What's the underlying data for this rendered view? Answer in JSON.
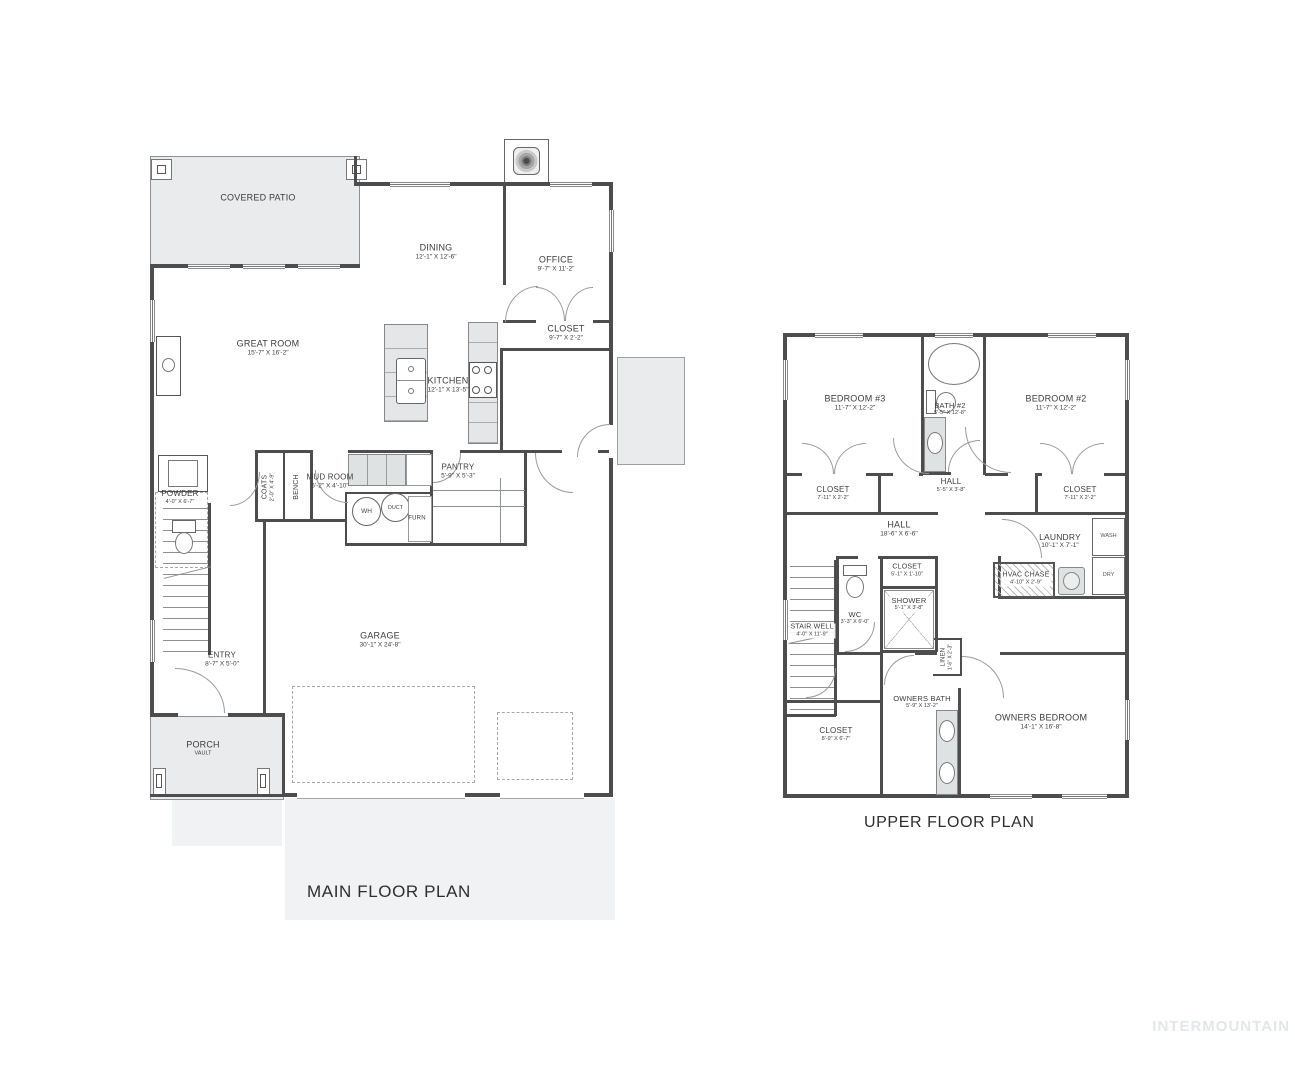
{
  "titles": {
    "main": "MAIN FLOOR PLAN",
    "upper": "UPPER FLOOR PLAN"
  },
  "watermark": "INTERMOUNTAIN",
  "colors": {
    "wall": "#4d4d4d",
    "fill": "#e9ebec",
    "line": "#9b9b9b",
    "text": "#3d3d3d"
  },
  "m": {
    "patio": {
      "name": "COVERED PATIO"
    },
    "dining": {
      "name": "DINING",
      "dims": "12'-1\" X 12'-6\""
    },
    "office": {
      "name": "OFFICE",
      "dims": "9'-7\" X 11'-2\""
    },
    "closet_office": {
      "name": "CLOSET",
      "dims": "9'-7\" X 2'-2\""
    },
    "great_room": {
      "name": "GREAT ROOM",
      "dims": "15'-7\" X 16'-2\""
    },
    "kitchen": {
      "name": "KITCHEN",
      "dims": "12'-1\" X 13'-5\""
    },
    "mud_room": {
      "name": "MUD ROOM",
      "dims": "5'-2\" X 4'-10\""
    },
    "pantry": {
      "name": "PANTRY",
      "dims": "5'-9\" X 5'-3\""
    },
    "coats": {
      "name": "COATS",
      "dims": "2'-0\" X 4'-9\""
    },
    "bench": {
      "name": "BENCH"
    },
    "wh": {
      "name": "WH"
    },
    "duct": {
      "name": "DUCT"
    },
    "furn": {
      "name": "FURN"
    },
    "powder": {
      "name": "POWDER",
      "dims": "4'-0\" X 6'-7\""
    },
    "entry": {
      "name": "ENTRY",
      "dims": "8'-7\" X 5'-0\""
    },
    "garage": {
      "name": "GARAGE",
      "dims": "30'-1\" X 24'-8\""
    },
    "porch": {
      "name": "PORCH",
      "sub": "VAULT"
    }
  },
  "u": {
    "bedroom3": {
      "name": "BEDROOM #3",
      "dims": "11'-7\" X 12'-2\""
    },
    "bath2": {
      "name": "BATH #2",
      "dims": "5'-5\" X 12'-8\""
    },
    "bedroom2": {
      "name": "BEDROOM #2",
      "dims": "11'-7\" X 12'-2\""
    },
    "closet_bed3": {
      "name": "CLOSET",
      "dims": "7'-11\" X 2'-2\""
    },
    "hall_upper": {
      "name": "HALL",
      "dims": "5'-5\" X 3'-8\""
    },
    "closet_bed2": {
      "name": "CLOSET",
      "dims": "7'-11\" X 2'-2\""
    },
    "hall_main": {
      "name": "HALL",
      "dims": "18'-6\" X 6'-6\""
    },
    "laundry": {
      "name": "LAUNDRY",
      "dims": "10'-1\" X 7'-1\""
    },
    "wash": {
      "name": "WASH"
    },
    "dry": {
      "name": "DRY"
    },
    "closet_hall": {
      "name": "CLOSET",
      "dims": "5'-1\" X 1'-10\""
    },
    "shower": {
      "name": "SHOWER",
      "dims": "5'-1\" X 3'-8\""
    },
    "wc": {
      "name": "WC",
      "dims": "3'-3\" X 6'-0\""
    },
    "stair_well": {
      "name": "STAIR WELL",
      "dims": "4'-0\" X 11'-9\""
    },
    "hvac": {
      "name": "HVAC CHASE",
      "dims": "4'-10\" X 2'-9\""
    },
    "linen": {
      "name": "LINEN",
      "dims": "1'-6\" X 2'-3\""
    },
    "owners_bath": {
      "name": "OWNERS BATH",
      "dims": "5'-9\" X 13'-2\""
    },
    "closet_owners": {
      "name": "CLOSET",
      "dims": "8'-9\" X 6'-7\""
    },
    "owners_bedroom": {
      "name": "OWNERS BEDROOM",
      "dims": "14'-1\" X 16'-8\""
    }
  }
}
